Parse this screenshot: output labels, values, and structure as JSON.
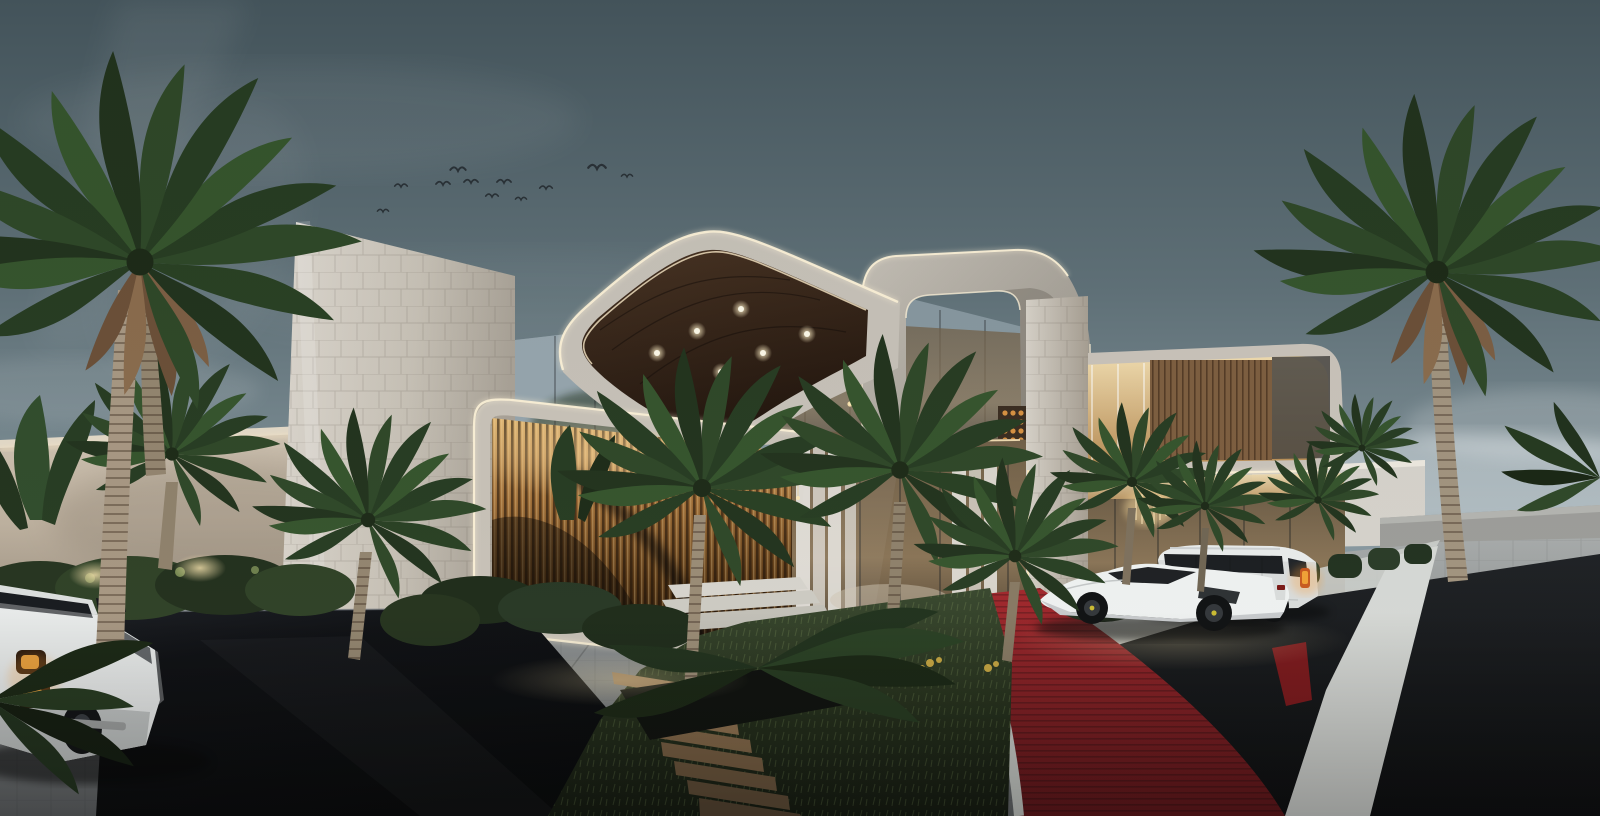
{
  "meta": {
    "scene_title": "Luxury modern villa at dusk — exterior architectural rendering",
    "image_type": "photorealistic 3D visualization",
    "canvas": {
      "width_px": 1600,
      "height_px": 816
    }
  },
  "palette": {
    "sky_top": "#45555b",
    "sky_mid": "#7f9097",
    "sky_horizon": "#c4ced2",
    "facade_light": "#d6cfc4",
    "facade_shadow": "#a29a8d",
    "soffit_wood": "#30211a",
    "bronze_louver_light": "#d8ac62",
    "bronze_louver_dark": "#271505",
    "led_strip": "#fdf4dc",
    "interior_warm": "#e7c089",
    "foliage_dark": "#1f3019",
    "foliage_light": "#3a5a30",
    "grass": "#25301b",
    "red_carpet": "#8f1b1f",
    "asphalt": "#0b0c0e",
    "pavement_grey": "#8f9293",
    "white_paving": "#d6d8d4",
    "black_wall": "#060709"
  },
  "sky": {
    "description": "overcast dusk sky, teal-grey above fading to pale blue clouds at the horizon",
    "light_beam": "soft diagonal light shaft in upper left",
    "birds_count": 11
  },
  "architecture": {
    "style": "contemporary curved white volumes outlined with continuous LED edge lighting",
    "elements": [
      {
        "name": "tiled-blade-wall",
        "desc": "tall white tiled feature wall"
      },
      {
        "name": "cantilever-canopy",
        "desc": "curved roof canopy, dark timber soffit",
        "downlights": 6
      },
      {
        "name": "portal-frame",
        "desc": "open rounded loop frame over right wing with sky visible through it"
      },
      {
        "name": "upper-suite-volume",
        "desc": "cantilevered upper floor, warm glass band with timber-slat wall"
      },
      {
        "name": "bronze-louver-screen",
        "desc": "vertical bronze louvers inside rounded LED frame"
      },
      {
        "name": "double-height-glazing",
        "desc": "glass curtain wall, sheer drapes, sputnik chandelier, pendants, sofa"
      },
      {
        "name": "entry-lobby",
        "desc": "glass lobby with crystal chandelier and amber wine-wall dots"
      },
      {
        "name": "tiled-pillar",
        "desc": "white tiled pillar with LED edge"
      }
    ],
    "perimeter_walls": {
      "left": "beige garden wall with warm LED cove under the coping",
      "right": "white wall and grey boundary wall beyond"
    }
  },
  "vehicles": [
    {
      "name": "suv-left",
      "desc": "white luxury SUV, rear three-quarter view, amber tail lights",
      "position": "bottom left"
    },
    {
      "name": "sports-car",
      "desc": "white mid-engine supercar, black wheels, yellow calipers",
      "position": "centre-right driveway"
    },
    {
      "name": "suv-right",
      "desc": "white full-size SUV, amber tail lights",
      "position": "behind sports car at entry"
    }
  ],
  "landscape": {
    "large_palms": 4,
    "small_palms": 8,
    "features": [
      "dried frond skirts on tall palms",
      "banana plants",
      "uplit shrubs along garden wall",
      "clipped hedges at entry",
      "lawn with yellow flowering shrubs"
    ]
  },
  "hardscape": {
    "features": [
      "grey cobble courtyard",
      "polished black feature wall",
      "timber steps with grass joints",
      "white stone steps",
      "red carpet driveway loop with white stone edging",
      "white diagonal paving band",
      "dark asphalt road"
    ]
  },
  "lighting": {
    "led_edge_strips": true,
    "canopy_downlights": 6,
    "interior_glow": "warm tone",
    "landscape_uplights": true
  }
}
